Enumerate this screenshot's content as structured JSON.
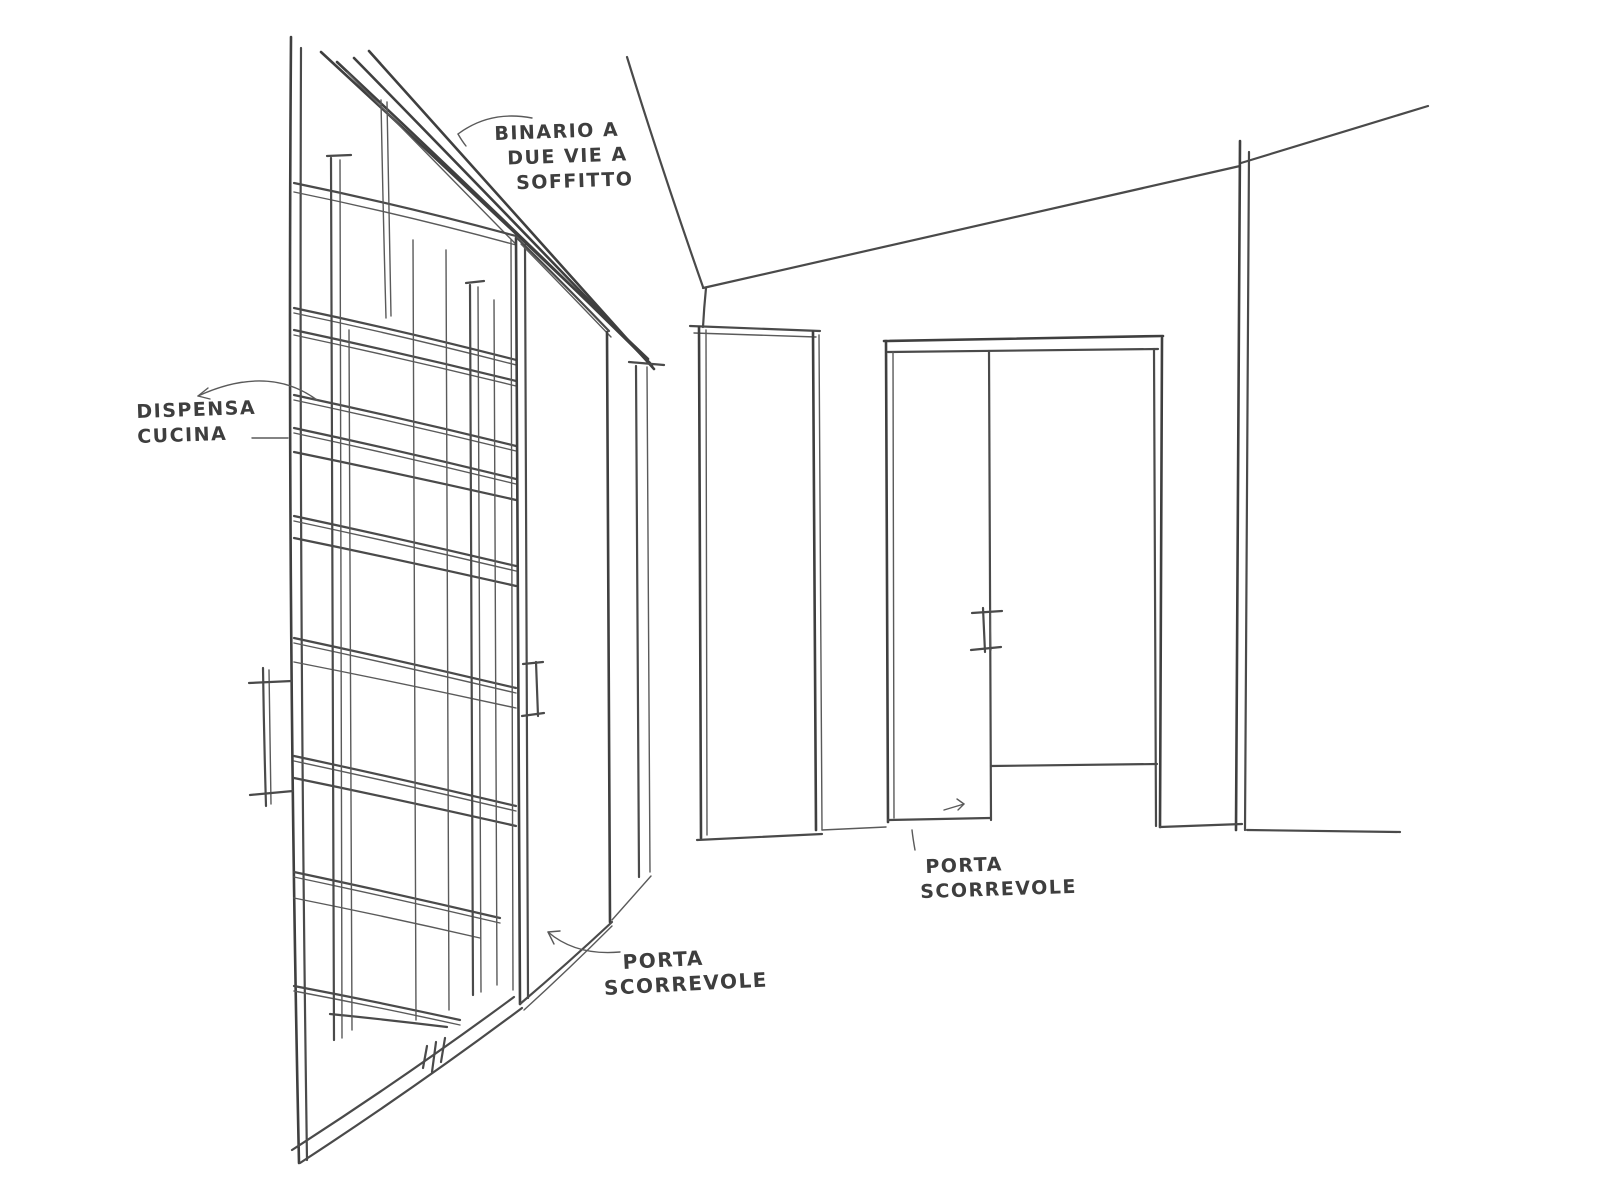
{
  "page": {
    "kind": "hand-drawn interior perspective sketch",
    "paper_color": "#ffffff",
    "ink_color": "#4a4a4a"
  },
  "annotations": {
    "binario": {
      "lines": [
        "BINARIO A",
        "DUE VIE A",
        "SOFFITTO"
      ]
    },
    "dispensa": {
      "lines": [
        "DISPENSA",
        "CUCINA"
      ]
    },
    "porta_centro": {
      "lines": [
        "PORTA",
        "SCORREVOLE"
      ]
    },
    "porta_destra": {
      "lines": [
        "PORTA",
        "SCORREVOLE"
      ]
    }
  }
}
